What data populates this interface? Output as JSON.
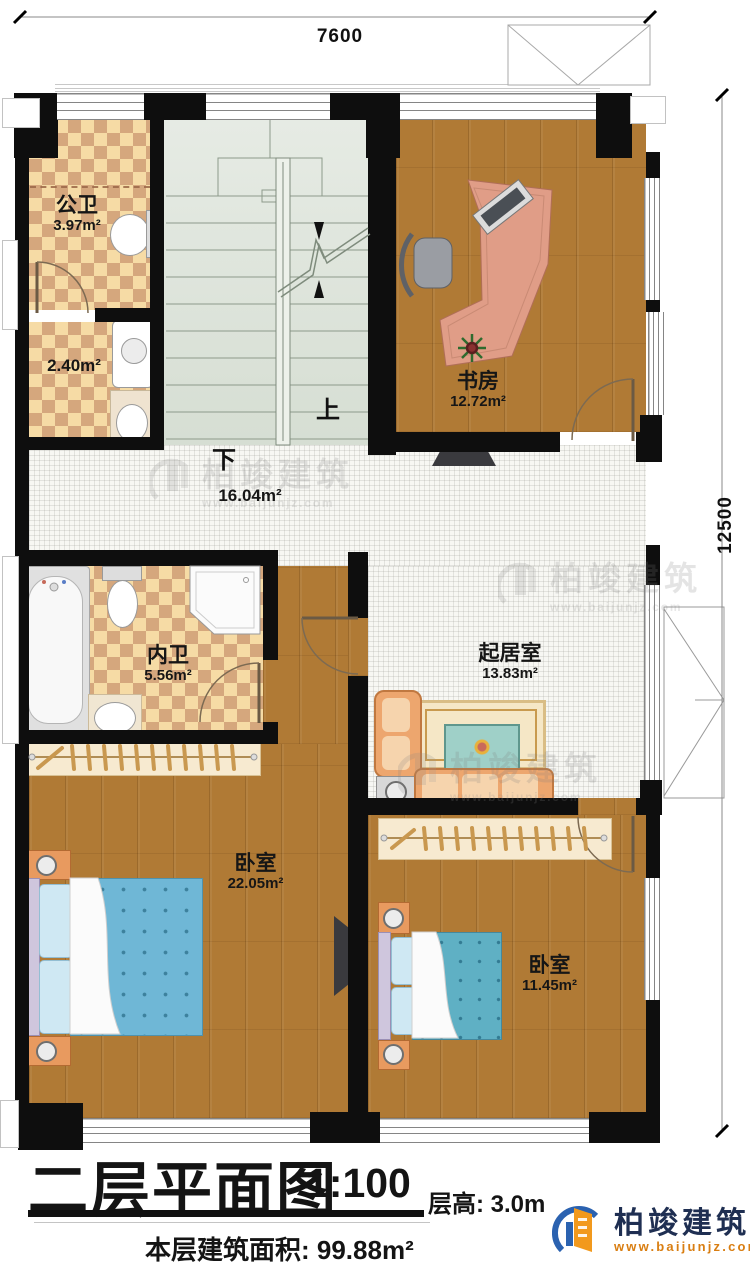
{
  "dimensions": {
    "width": "7600",
    "height": "12500"
  },
  "stairs": {
    "up": "上",
    "down": "下"
  },
  "rooms": {
    "public_bath": {
      "name": "公卫",
      "area": "3.97m²"
    },
    "laundry": {
      "area": "2.40m²"
    },
    "study": {
      "name": "书房",
      "area": "12.72m²"
    },
    "hall": {
      "area": "16.04m²"
    },
    "ensuite": {
      "name": "内卫",
      "area": "5.56m²"
    },
    "living": {
      "name": "起居室",
      "area": "13.83m²"
    },
    "master_bedroom": {
      "name": "卧室",
      "area": "22.05m²"
    },
    "second_bedroom": {
      "name": "卧室",
      "area": "11.45m²"
    }
  },
  "title_block": {
    "title": "二层平面图",
    "scale": "1:100",
    "floor_height_label": "层高: 3.0m",
    "floor_area_label": "本层建筑面积: 99.88m²"
  },
  "brand": {
    "name": "柏竣建筑",
    "website": "www.baijunjz.com"
  },
  "colors": {
    "wall": "#0e0e0e",
    "wood": "#b07a35",
    "tile_light": "#f6dba5",
    "tile_dark": "#d5a77d",
    "stair": "#dde5da",
    "bed_blue": "#6fb7d6",
    "logo_blue": "#2b62b0",
    "logo_orange": "#f2991d"
  }
}
